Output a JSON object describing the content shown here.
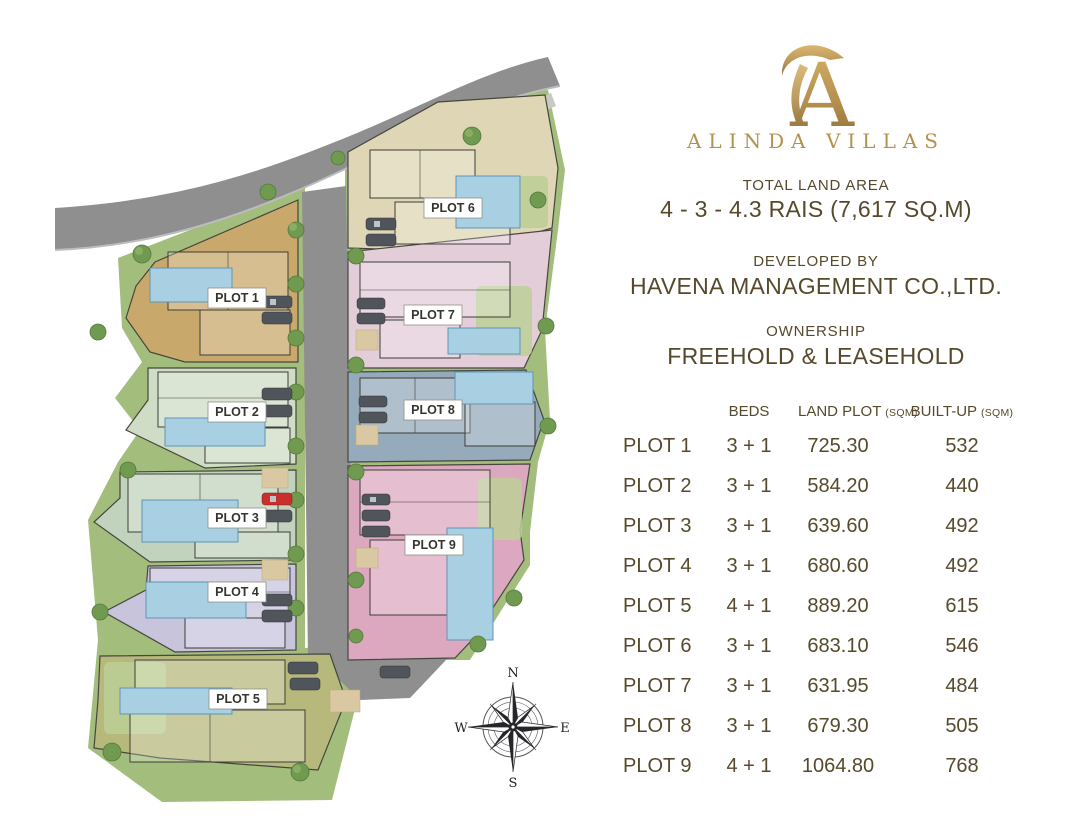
{
  "palette": {
    "gold": "#b5914f",
    "gold-dark": "#8a6a33",
    "text": "#56492c",
    "road": "#8f8f90",
    "road-edge": "#bcbcbc",
    "sidewalk": "#c8c8c6",
    "green": "#a3bd7d",
    "green-mid": "#8fb269",
    "green-dark": "#6f9a4f",
    "green-stroke": "#557a3a",
    "green-light": "#bccf97",
    "sand": "#d9c8a1",
    "pool": "#a9cfe2",
    "pool-stroke": "#6096b6",
    "car": "#50555c",
    "car-red": "#c9302c"
  },
  "brand": {
    "monogram": "A",
    "name": "ALINDA VILLAS"
  },
  "info": {
    "total_land_area_label": "TOTAL LAND AREA",
    "total_land_area_value": "4 - 3 - 4.3 RAIS (7,617 SQ.M)",
    "developed_by_label": "DEVELOPED BY",
    "developer": "HAVENA MANAGEMENT CO.,LTD.",
    "ownership_label": "OWNERSHIP",
    "ownership_value": "FREEHOLD & LEASEHOLD"
  },
  "table": {
    "headers": {
      "beds": "BEDS",
      "land_plot": "LAND PLOT",
      "land_plot_unit": "(SQM)",
      "built_up": "BUILT-UP",
      "built_up_unit": "(SQM)"
    },
    "rows": [
      {
        "plot": "PLOT 1",
        "beds": "3 + 1",
        "land_plot": "725.30",
        "built_up": "532"
      },
      {
        "plot": "PLOT 2",
        "beds": "3 + 1",
        "land_plot": "584.20",
        "built_up": "440"
      },
      {
        "plot": "PLOT 3",
        "beds": "3 + 1",
        "land_plot": "639.60",
        "built_up": "492"
      },
      {
        "plot": "PLOT 4",
        "beds": "3 + 1",
        "land_plot": "680.60",
        "built_up": "492"
      },
      {
        "plot": "PLOT 5",
        "beds": "4 + 1",
        "land_plot": "889.20",
        "built_up": "615"
      },
      {
        "plot": "PLOT 6",
        "beds": "3 + 1",
        "land_plot": "683.10",
        "built_up": "546"
      },
      {
        "plot": "PLOT 7",
        "beds": "3 + 1",
        "land_plot": "631.95",
        "built_up": "484"
      },
      {
        "plot": "PLOT 8",
        "beds": "3 + 1",
        "land_plot": "679.30",
        "built_up": "505"
      },
      {
        "plot": "PLOT 9",
        "beds": "4 + 1",
        "land_plot": "1064.80",
        "built_up": "768"
      }
    ]
  },
  "site_plan": {
    "plots": [
      {
        "label": "PLOT 1",
        "color": "#c9a86b"
      },
      {
        "label": "PLOT 2",
        "color": "#cfdcc6"
      },
      {
        "label": "PLOT 3",
        "color": "#c2d3bd"
      },
      {
        "label": "PLOT 4",
        "color": "#c7c4dc"
      },
      {
        "label": "PLOT 5",
        "color": "#b7b97c"
      },
      {
        "label": "PLOT 6",
        "color": "#ded6b4"
      },
      {
        "label": "PLOT 7",
        "color": "#e3cdd8"
      },
      {
        "label": "PLOT 8",
        "color": "#95aaba"
      },
      {
        "label": "PLOT 9",
        "color": "#dca8c0"
      }
    ],
    "compass": {
      "north": "N",
      "east": "E",
      "south": "S",
      "west": "W"
    }
  }
}
